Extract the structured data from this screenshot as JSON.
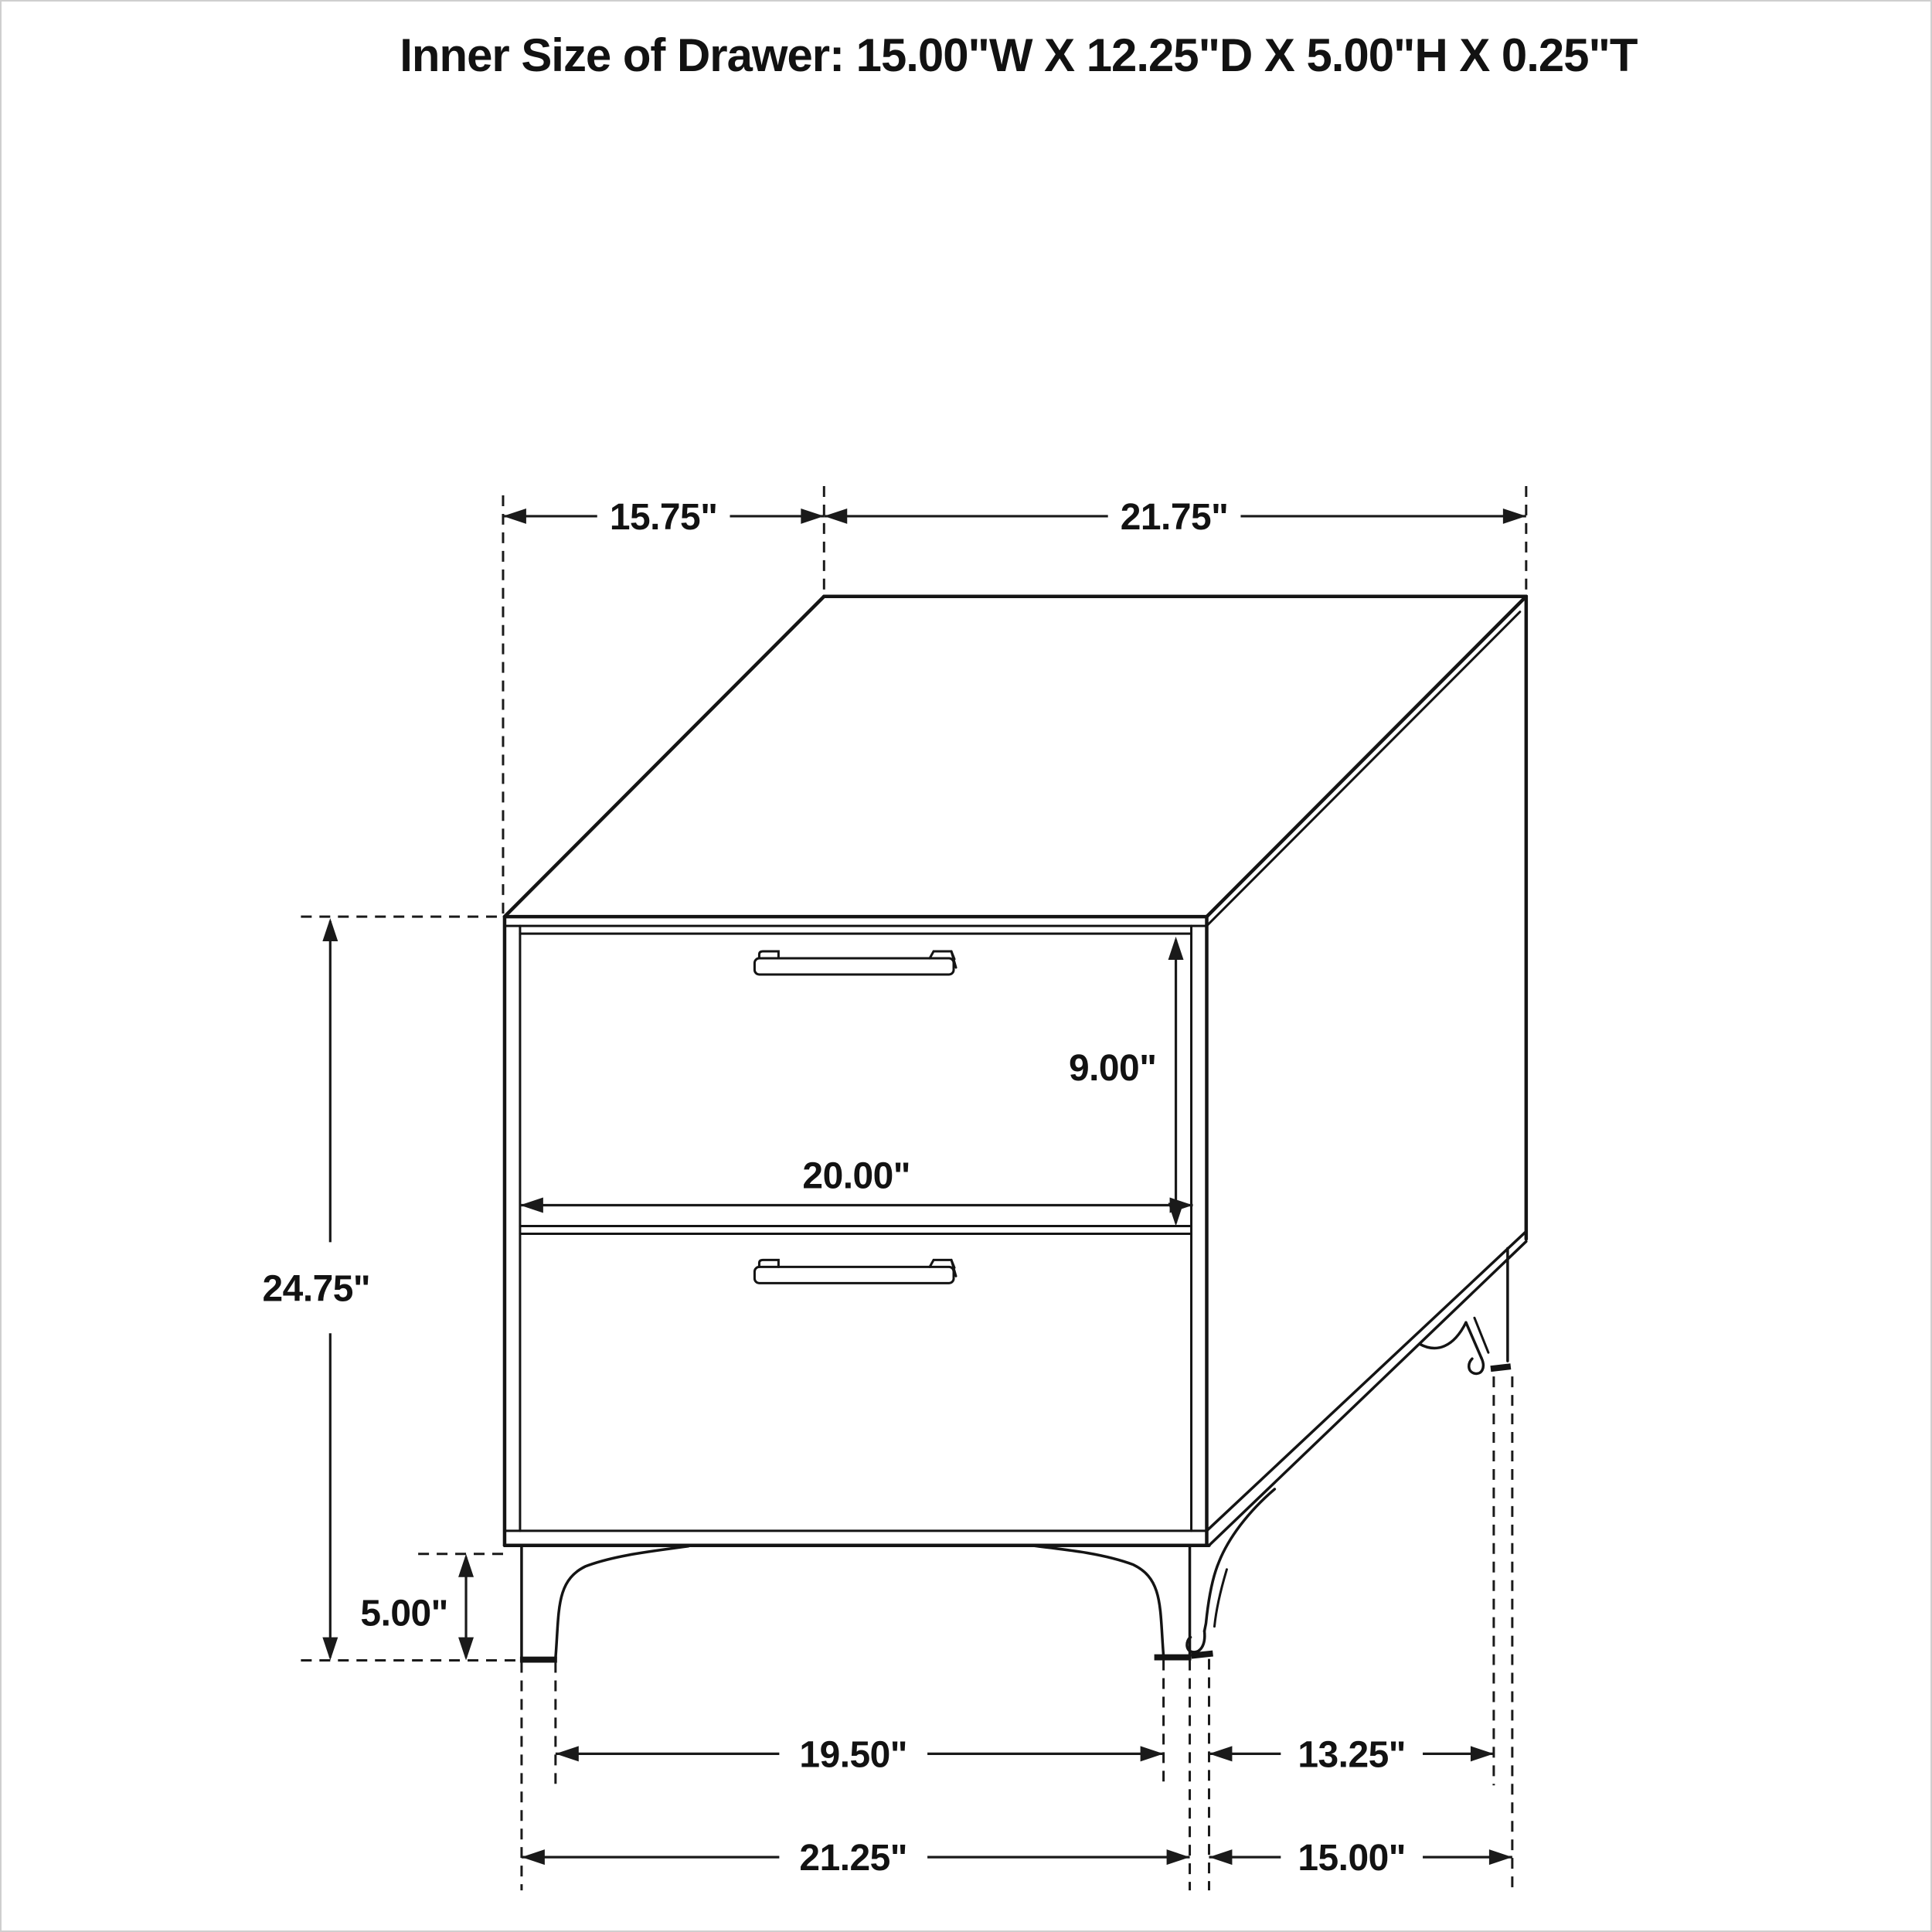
{
  "title": "Inner Size of Drawer: 15.00\"W X 12.25\"D X 5.00\"H X 0.25\"T",
  "diagram": {
    "kind": "dimensioned line drawing",
    "object": "two-drawer nightstand with metal bar pulls and flared legs",
    "view": "three-quarter perspective from front-right",
    "drawer_count": 2,
    "colors": {
      "line": "#141414",
      "background": "#ffffff"
    }
  },
  "labels": {
    "top_depth": "15.75\"",
    "top_width": "21.75\"",
    "overall_height": "24.75\"",
    "drawer_front_height": "9.00\"",
    "drawer_front_width": "20.00\"",
    "leg_height": "5.00\"",
    "front_feet_inner_span": "19.50\"",
    "side_feet_inner_span": "13.25\"",
    "front_feet_outer_span": "21.25\"",
    "side_feet_outer_span": "15.00\""
  },
  "inner_drawer_size": {
    "width_in": 15.0,
    "depth_in": 12.25,
    "height_in": 5.0,
    "thickness_in": 0.25
  },
  "outer_dimensions_in": {
    "top_depth": 15.75,
    "top_width": 21.75,
    "overall_height": 24.75,
    "drawer_front_height": 9.0,
    "drawer_front_width": 20.0,
    "leg_height": 5.0,
    "front_feet_inner_span": 19.5,
    "side_feet_inner_span": 13.25,
    "front_feet_outer_span": 21.25,
    "side_feet_outer_span": 15.0
  }
}
